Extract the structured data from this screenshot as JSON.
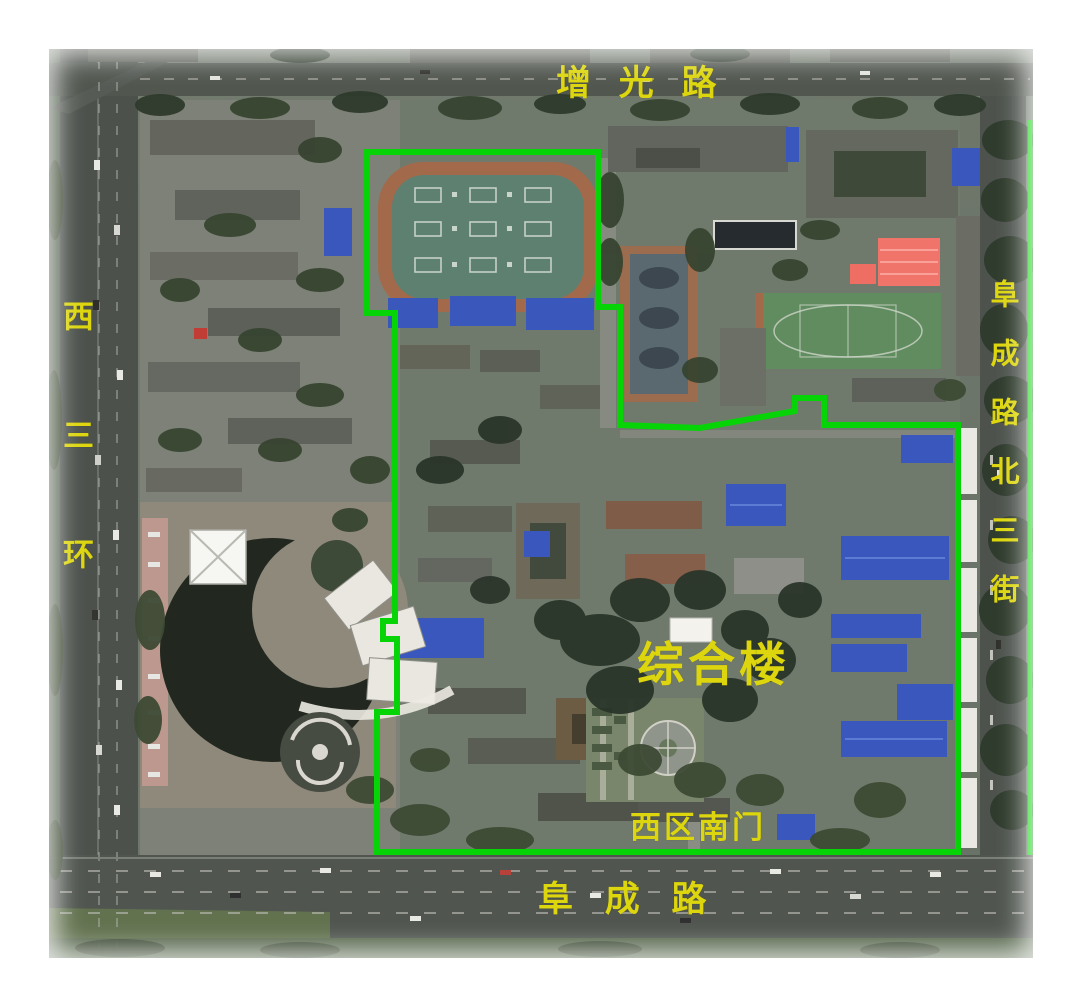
{
  "colors": {
    "boundary_green": "#07d407",
    "label_yellow": "#ddd60e",
    "margin_white": "#ffffff"
  },
  "labels": {
    "top_road": "增 光 路",
    "left_road": "西三环",
    "right_road": "阜成路北三街",
    "bottom_road": "阜 成 路",
    "center_building": "综合楼",
    "south_gate": "西区南门"
  }
}
